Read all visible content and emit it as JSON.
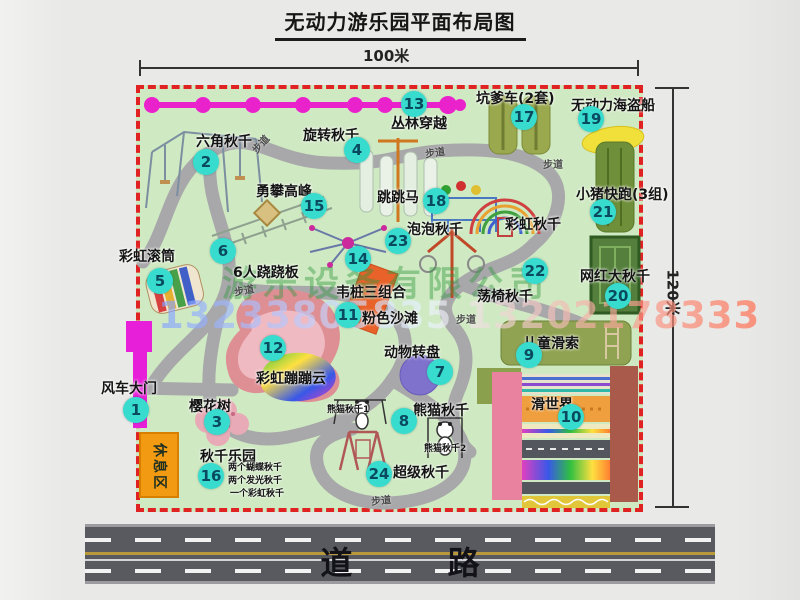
{
  "title": "无动力游乐园平面布局图",
  "dimensions": {
    "width_label": "100米",
    "height_label": "120米"
  },
  "watermark": {
    "company": "游乐设备有限公司",
    "phone": "13233805835 13202178333"
  },
  "road": {
    "label": "道 路"
  },
  "colors": {
    "park_green": "#cfe9c2",
    "border_red": "#e02222",
    "badge_cyan": "#38dccf",
    "path_gray": "#a8a8aa",
    "road_gray": "#595a60",
    "gate_magenta": "#e81fd8",
    "zipline_magenta": "#ea22cc",
    "rest_orange": "#f29a12",
    "watermark_green": "#2d963c",
    "pirate_yellow": "#f2e03a"
  },
  "park": {
    "rest_area_label": "休息区",
    "attractions": [
      {
        "num": "1",
        "label": "风车大门",
        "lx": 101,
        "ly": 378,
        "bx": 136,
        "by": 410
      },
      {
        "num": "2",
        "label": "六角秋千",
        "lx": 196,
        "ly": 131,
        "bx": 206,
        "by": 162
      },
      {
        "num": "3",
        "label": "樱花树",
        "lx": 189,
        "ly": 396,
        "bx": 217,
        "by": 422
      },
      {
        "num": "4",
        "label": "旋转秋千",
        "lx": 303,
        "ly": 125,
        "bx": 357,
        "by": 150
      },
      {
        "num": "5",
        "label": "彩虹滚筒",
        "lx": 119,
        "ly": 246,
        "bx": 160,
        "by": 281
      },
      {
        "num": "6",
        "label": "6人跷跷板",
        "lx": 233,
        "ly": 262,
        "bx": 223,
        "by": 251
      },
      {
        "num": "7",
        "label": "动物转盘",
        "lx": 384,
        "ly": 342,
        "bx": 440,
        "by": 372
      },
      {
        "num": "8",
        "label": "熊猫秋千",
        "lx": 413,
        "ly": 400,
        "bx": 404,
        "by": 421
      },
      {
        "num": "9",
        "label": "儿童滑索",
        "lx": 523,
        "ly": 333,
        "bx": 529,
        "by": 355
      },
      {
        "num": "10",
        "label": "滑世界",
        "lx": 531,
        "ly": 394,
        "bx": 571,
        "by": 417
      },
      {
        "num": "11",
        "label": "粉色沙滩",
        "lx": 362,
        "ly": 308,
        "bx": 348,
        "by": 315
      },
      {
        "num": "12",
        "label": "彩虹蹦蹦云",
        "lx": 256,
        "ly": 368,
        "bx": 273,
        "by": 348
      },
      {
        "num": "13",
        "label": "丛林穿越",
        "lx": 391,
        "ly": 113,
        "bx": 414,
        "by": 104
      },
      {
        "num": "14",
        "label": "韦桩三组合",
        "lx": 336,
        "ly": 282,
        "bx": 358,
        "by": 259
      },
      {
        "num": "15",
        "label": "勇攀高峰",
        "lx": 256,
        "ly": 181,
        "bx": 314,
        "by": 206
      },
      {
        "num": "16",
        "label": "秋千乐园",
        "lx": 200,
        "ly": 446,
        "bx": 211,
        "by": 476
      },
      {
        "num": "17",
        "label": "坑爹车(2套)",
        "lx": 476,
        "ly": 88,
        "bx": 524,
        "by": 117
      },
      {
        "num": "18",
        "label": "跳跳马",
        "lx": 377,
        "ly": 187,
        "bx": 436,
        "by": 201
      },
      {
        "num": "19",
        "label": "无动力海盗船",
        "lx": 571,
        "ly": 95,
        "bx": 591,
        "by": 119
      },
      {
        "num": "20",
        "label": "网红大秋千",
        "lx": 580,
        "ly": 266,
        "bx": 618,
        "by": 296
      },
      {
        "num": "21",
        "label": "小猪快跑(3组)",
        "lx": 576,
        "ly": 184,
        "bx": 603,
        "by": 212
      },
      {
        "num": "22",
        "label": "荡椅秋千",
        "lx": 477,
        "ly": 286,
        "bx": 535,
        "by": 271
      },
      {
        "num": "23",
        "label": "泡泡秋千",
        "lx": 407,
        "ly": 219,
        "bx": 398,
        "by": 241
      },
      {
        "num": "24",
        "label": "超级秋千",
        "lx": 393,
        "ly": 462,
        "bx": 379,
        "by": 474
      }
    ],
    "plain_labels": [
      {
        "text": "彩虹秋千",
        "x": 505,
        "y": 214,
        "small": false
      },
      {
        "text": "熊猫秋千1",
        "x": 327,
        "y": 402,
        "small": true
      },
      {
        "text": "熊猫秋千2",
        "x": 424,
        "y": 441,
        "small": true
      },
      {
        "text": "两个蝴蝶秋千",
        "x": 228,
        "y": 460,
        "small": true
      },
      {
        "text": "两个发光秋千",
        "x": 228,
        "y": 473,
        "small": true
      },
      {
        "text": "一个彩虹秋千",
        "x": 230,
        "y": 486,
        "small": true
      }
    ],
    "path_labels": [
      {
        "text": "步道",
        "x": 250,
        "y": 136,
        "rot": -48
      },
      {
        "text": "步道",
        "x": 425,
        "y": 144,
        "rot": -8
      },
      {
        "text": "步道",
        "x": 543,
        "y": 156,
        "rot": 0
      },
      {
        "text": "步道",
        "x": 234,
        "y": 282,
        "rot": -10
      },
      {
        "text": "步道",
        "x": 456,
        "y": 311,
        "rot": 0
      },
      {
        "text": "步道",
        "x": 371,
        "y": 492,
        "rot": -6
      }
    ]
  }
}
